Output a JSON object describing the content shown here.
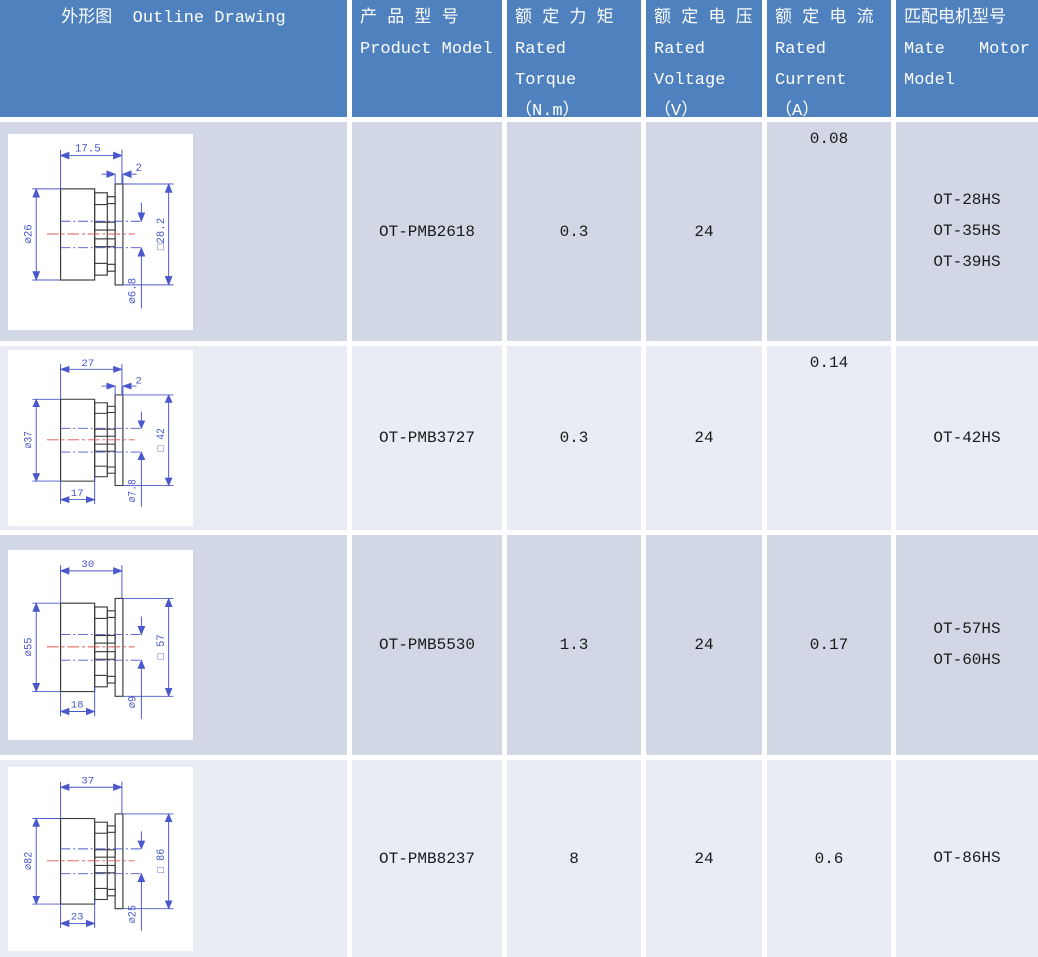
{
  "header": {
    "outline": "外形图  Outline Drawing",
    "product": [
      "产 品 型 号",
      "Product Model"
    ],
    "torque": [
      "额 定 力 矩",
      "Rated",
      "Torque",
      "（N.m）"
    ],
    "voltage": [
      "额 定 电 压",
      "Rated",
      "Voltage",
      "（V）"
    ],
    "current": [
      "额 定 电 流",
      "Rated",
      "Current",
      "（A）"
    ],
    "motor": {
      "line1": "匹配电机型号",
      "line2a": "Mate",
      "line2b": "Motor",
      "line3": "Model"
    }
  },
  "rows": [
    {
      "model": "OT-PMB2618",
      "torque": "0.3",
      "voltage": "24",
      "current": "0.08",
      "motors": [
        "OT-28HS",
        "OT-35HS",
        "OT-39HS"
      ],
      "drawing": {
        "length": "17.5",
        "flange": "2",
        "diameter": "⌀26",
        "square": "□28.2",
        "shaft": "⌀6.8"
      }
    },
    {
      "model": "OT-PMB3727",
      "torque": "0.3",
      "voltage": "24",
      "current": "0.14",
      "motors": [
        "OT-42HS"
      ],
      "drawing": {
        "length": "27",
        "flange": "2",
        "diameter": "⌀37",
        "square": "□ 42",
        "shaft": "⌀7.8",
        "hub_length": "17"
      }
    },
    {
      "model": "OT-PMB5530",
      "torque": "1.3",
      "voltage": "24",
      "current": "0.17",
      "motors": [
        "OT-57HS",
        "OT-60HS"
      ],
      "drawing": {
        "length": "30",
        "diameter": "⌀55",
        "square": "□ 57",
        "shaft": "⌀9",
        "hub_length": "18"
      }
    },
    {
      "model": "OT-PMB8237",
      "torque": "8",
      "voltage": "24",
      "current": "0.6",
      "motors": [
        "OT-86HS"
      ],
      "drawing": {
        "length": "37",
        "diameter": "⌀82",
        "square": "□ 86",
        "shaft": "⌀25",
        "hub_length": "23"
      }
    }
  ],
  "colors": {
    "header_bg": "#4e81bd",
    "header_text": "#ffffff",
    "row_dark": "#d2d7e5",
    "row_light": "#e9ecf4",
    "dimension_blue": "#4a58cc",
    "centerline_red": "#e05555",
    "drawing_bg": "#ffffff"
  }
}
